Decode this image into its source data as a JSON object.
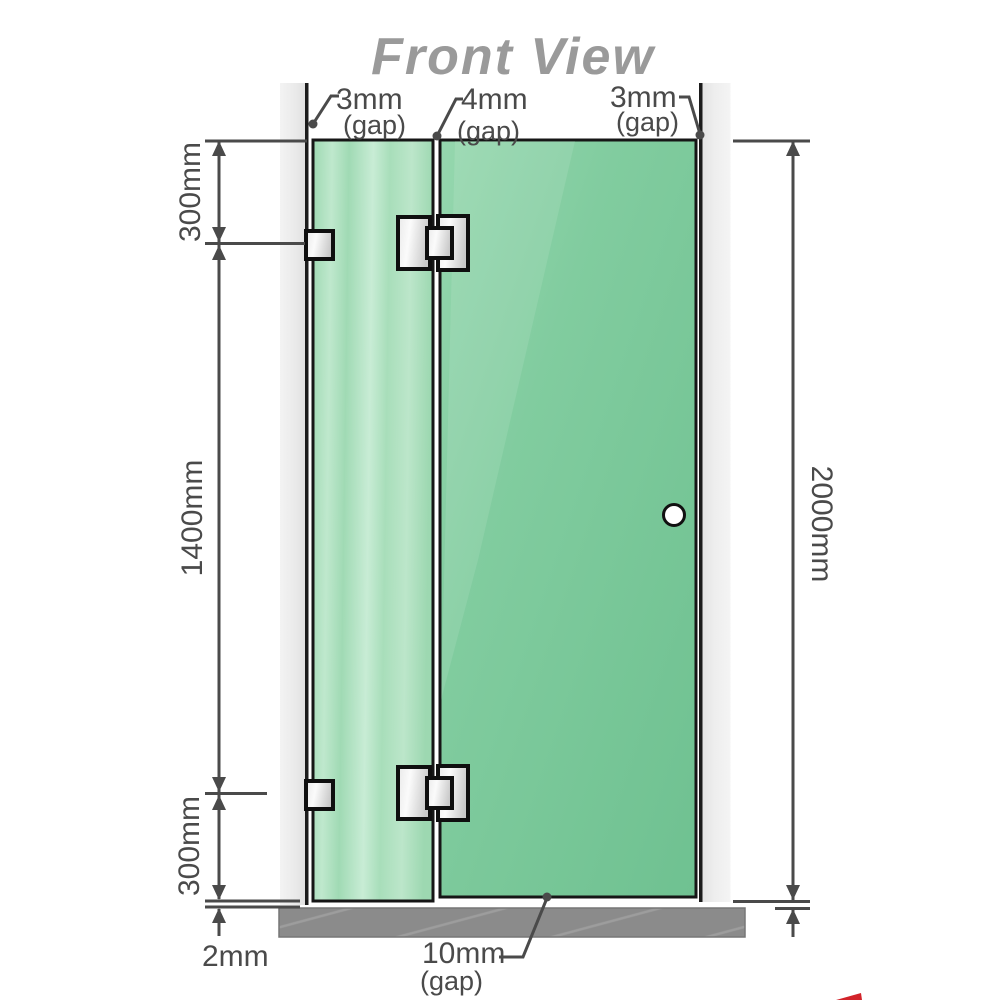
{
  "title": "Front View",
  "colors": {
    "glass_green": "#84CC9E",
    "glass_green_light": "#A6DCBA",
    "wall_gray": "#EDEDED",
    "base_gray": "#8B8B8B",
    "outline_black": "#161616",
    "dimension_gray": "#4A4A4A",
    "title_gray": "#9A9A9A",
    "accent_red": "#D2232A"
  },
  "dimensions": {
    "top_gap_left": {
      "value": "3mm",
      "qualifier": "(gap)"
    },
    "top_gap_middle": {
      "value": "4mm",
      "qualifier": "(gap)"
    },
    "top_gap_right": {
      "value": "3mm",
      "qualifier": "(gap)"
    },
    "left_top": "300mm",
    "left_middle": "1400mm",
    "left_bottom": "300mm",
    "left_base_gap": "2mm",
    "right_height": "2000mm",
    "bottom_gap": {
      "value": "10mm",
      "qualifier": "(gap)"
    }
  }
}
